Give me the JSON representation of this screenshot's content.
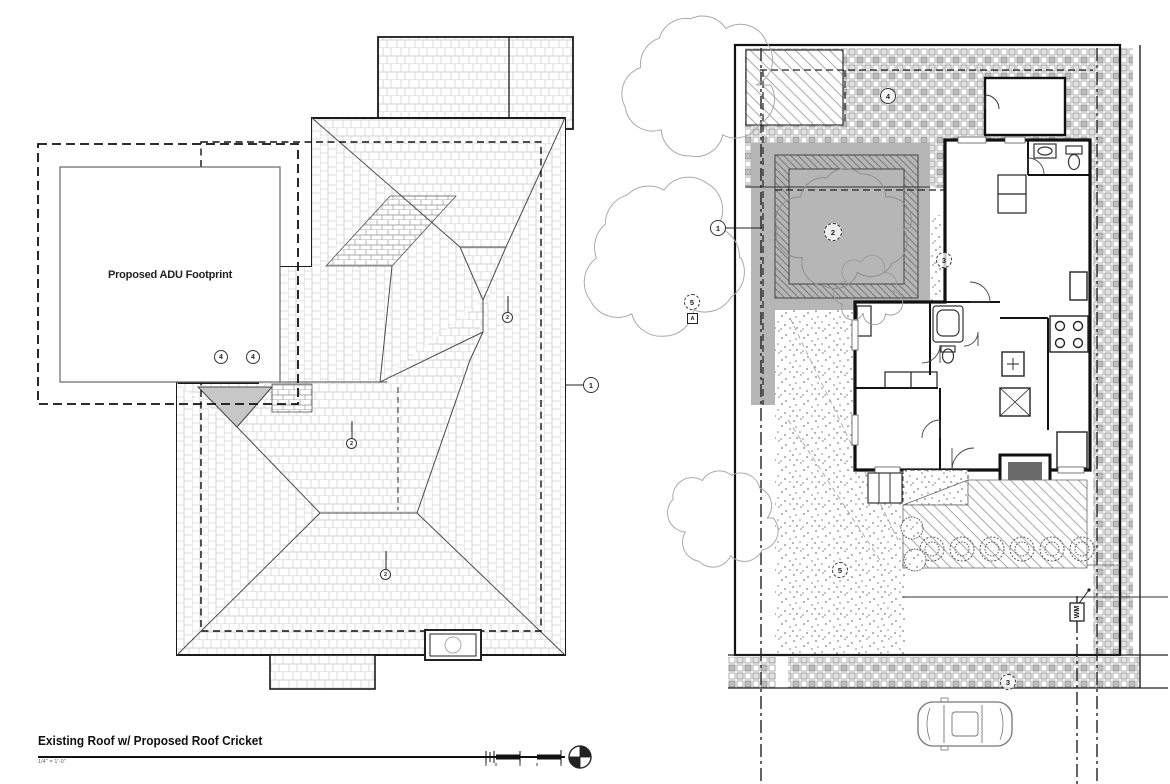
{
  "roof_plan": {
    "footprint_label": "Proposed ADU Footprint",
    "title": "Existing Roof w/ Proposed Roof Cricket",
    "scale_note": "1/4\" = 1'-0\"",
    "keynotes": [
      {
        "label": "4"
      },
      {
        "label": "4"
      },
      {
        "label": "1"
      },
      {
        "label": "2"
      },
      {
        "label": "2"
      },
      {
        "label": "2"
      }
    ]
  },
  "site_plan": {
    "keynotes": [
      {
        "label": "4"
      },
      {
        "label": "1"
      },
      {
        "label": "2"
      },
      {
        "label": "3"
      },
      {
        "label": "5"
      },
      {
        "label": "A"
      },
      {
        "label": "5"
      },
      {
        "label": "3"
      }
    ],
    "water_meter_label": "WM"
  },
  "colors": {
    "line": "#1a1a1a",
    "roof_hatch": "#bdbdbd",
    "shade_gray": "#b6b6b6",
    "cricket_gray": "#c7c7c7"
  }
}
